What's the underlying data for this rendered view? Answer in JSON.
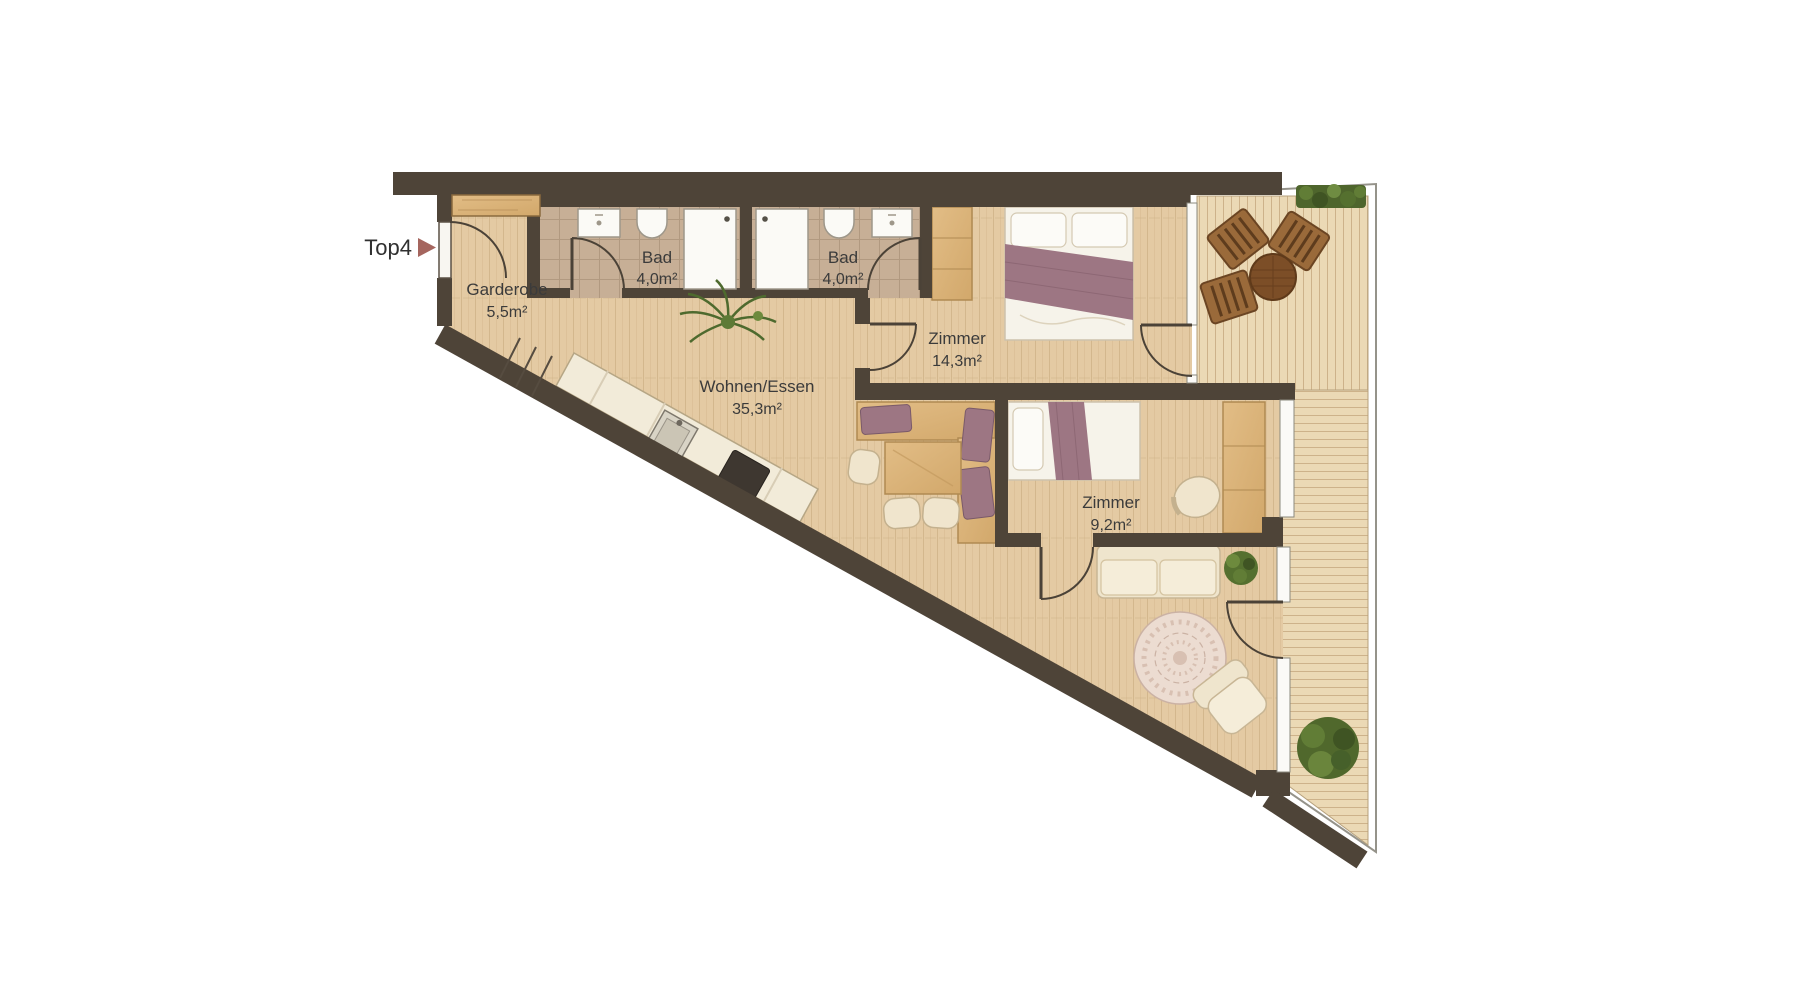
{
  "plan": {
    "unit": {
      "label": "Top4"
    },
    "rooms": [
      {
        "id": "garderobe",
        "name": "Garderobe",
        "area": "5,5m²"
      },
      {
        "id": "bad-1",
        "name": "Bad",
        "area": "4,0m²"
      },
      {
        "id": "bad-2",
        "name": "Bad",
        "area": "4,0m²"
      },
      {
        "id": "zimmer-1",
        "name": "Zimmer",
        "area": "14,3m²"
      },
      {
        "id": "wohnen-essen",
        "name": "Wohnen/Essen",
        "area": "35,3m²"
      },
      {
        "id": "zimmer-2",
        "name": "Zimmer",
        "area": "9,2m²"
      }
    ],
    "colors": {
      "wall": "#4e4438",
      "floor_wood": "#e4caa3",
      "deck_wood": "#ebd9b5",
      "bath_tile": "#c7af96",
      "accent_arrow": "#a5655e",
      "label_text": "#3b3b3b",
      "furniture_wood": "#dcb47c",
      "textile_mauve": "#9d7683",
      "plant_green": "#55702f",
      "upholstery_cream": "#f0e5cd"
    }
  }
}
